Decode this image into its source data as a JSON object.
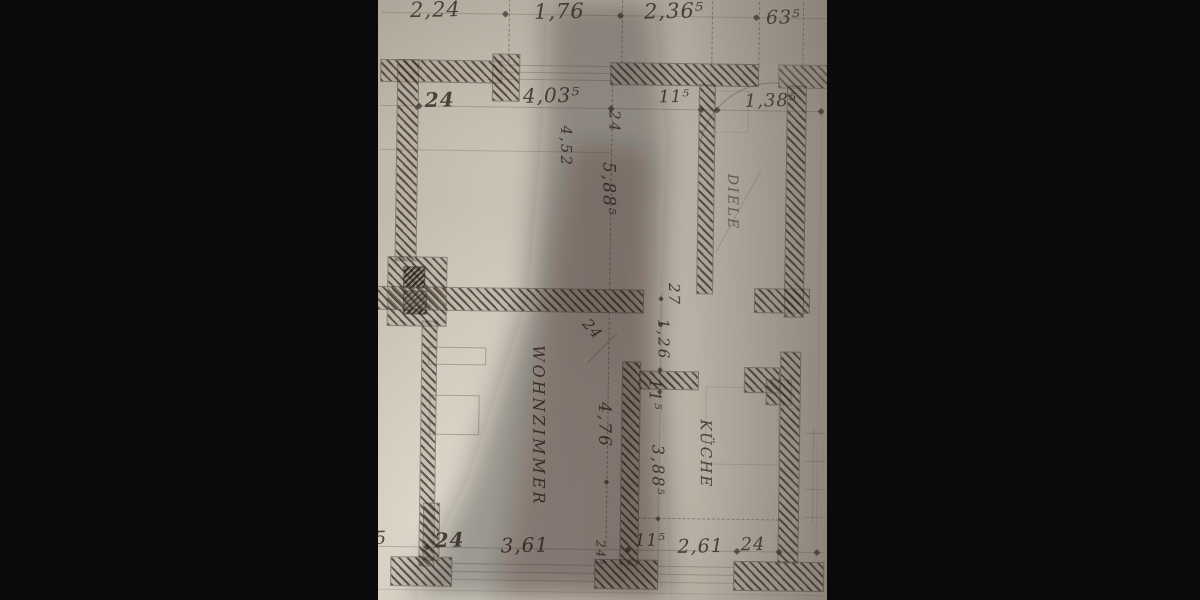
{
  "rooms": {
    "living_room": "WOHNZIMMER",
    "kitchen": "KÜCHE",
    "hallway": "DIELE"
  },
  "dims": {
    "top_chain": [
      "2,24",
      "1,76",
      "2,36⁵",
      "63⁵"
    ],
    "upper_chain": [
      "24",
      "4,03⁵",
      "24",
      "11⁵",
      "1,38⁵"
    ],
    "left_column": {
      "upper": "4,52",
      "depth": "5,88⁵"
    },
    "center_column": {
      "wall": "24",
      "living_depth": "4,76"
    },
    "kitchen_column": {
      "wall_top": "27",
      "opening": "1,26",
      "wall": "11⁵",
      "depth": "3,88⁵"
    },
    "bottom_chain": [
      "5",
      "24",
      "3,61",
      "24⁵",
      "11⁵",
      "2,61",
      "24"
    ]
  },
  "colors": {
    "paper": "#c9c1b4",
    "wall_hatch": "#4e463c",
    "pencil": "#6a6054",
    "letterbox": "#0b0b0d"
  }
}
